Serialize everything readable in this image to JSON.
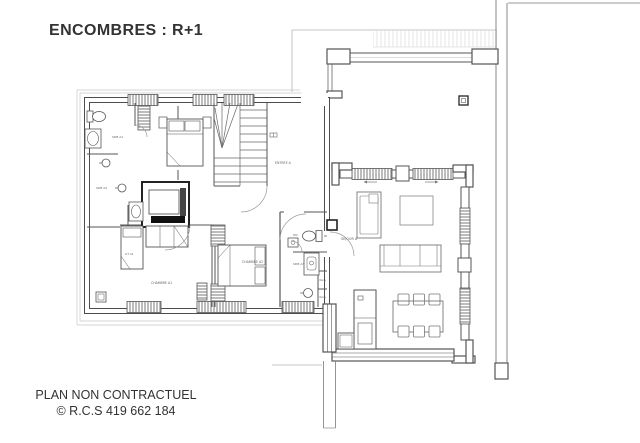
{
  "title": "ENCOMBRES : R+1",
  "plan": {
    "labels": {
      "sdb_a1": "SDB A1",
      "sdb_a2": "SDB A2",
      "entree_a": "ENTREE A",
      "lit_a1": "LIT A1",
      "chambre_a1": "CHAMBRE A1",
      "chambre_a2": "CHAMBRE A2",
      "wc": "WC",
      "sdb_a3": "SDB A3",
      "rang_top": "Rang.",
      "rang_bottom": "Rang.",
      "sejour_a": "SEJOUR A"
    },
    "colors": {
      "wall": "#4d4d4d",
      "light_line": "#c4c4c4",
      "dark_fill": "#161616",
      "label": "#666666"
    }
  },
  "footer": {
    "line1": "PLAN NON CONTRACTUEL",
    "line2": "© R.C.S 419 662 184"
  }
}
